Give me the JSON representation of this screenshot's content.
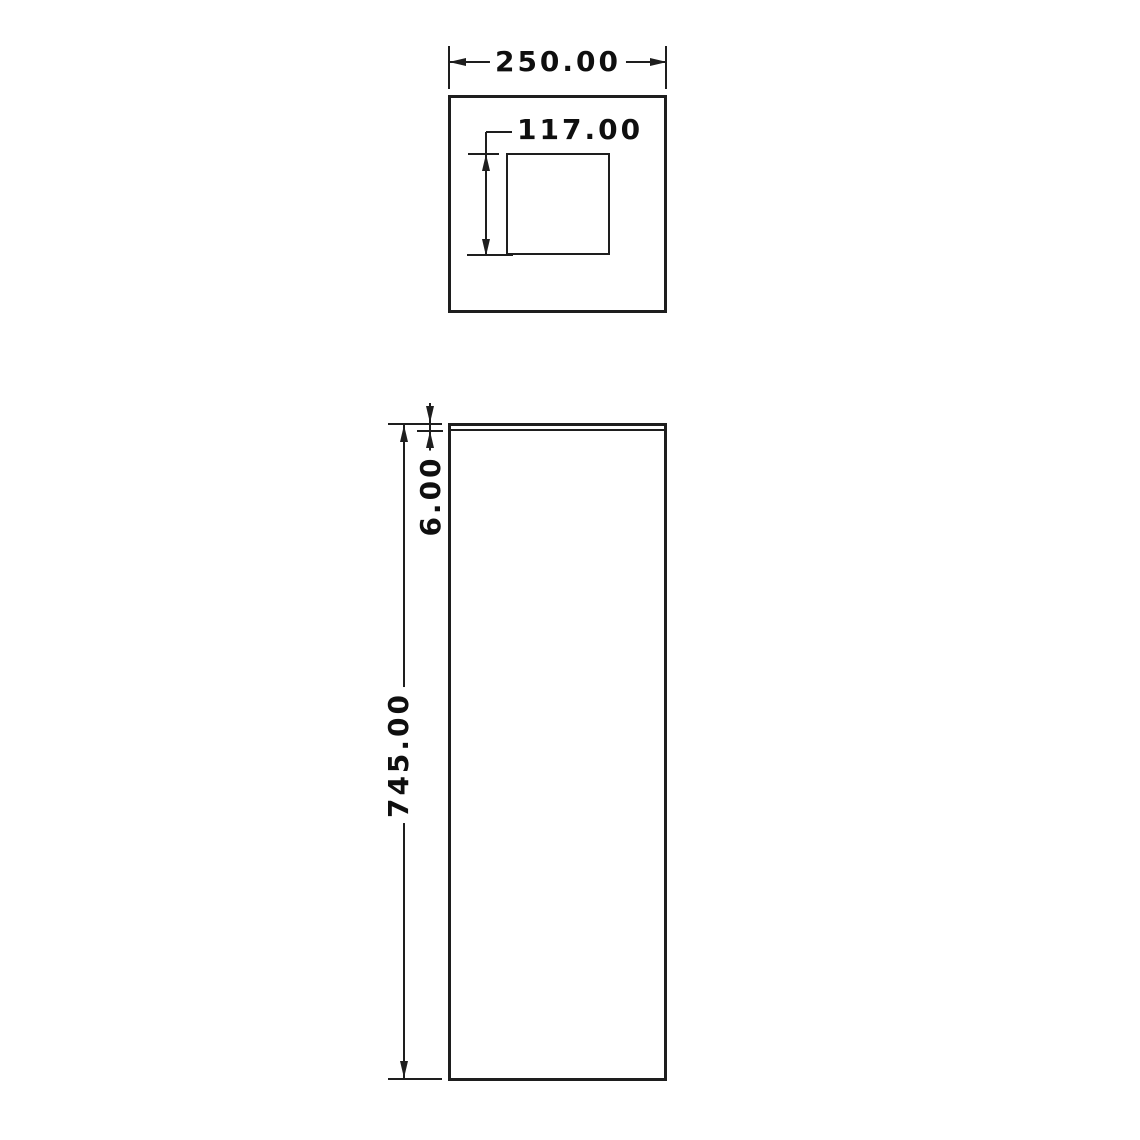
{
  "document": {
    "colors": {
      "background": "#ffffff",
      "line": "#1e1e1e",
      "text": "#0f0f0f"
    }
  },
  "views": {
    "top": {
      "dims": {
        "outer_width": "250.00",
        "cutout_height": "117.00"
      }
    },
    "front": {
      "dims": {
        "overall_height": "745.00",
        "top_thickness": "6.00"
      }
    }
  }
}
